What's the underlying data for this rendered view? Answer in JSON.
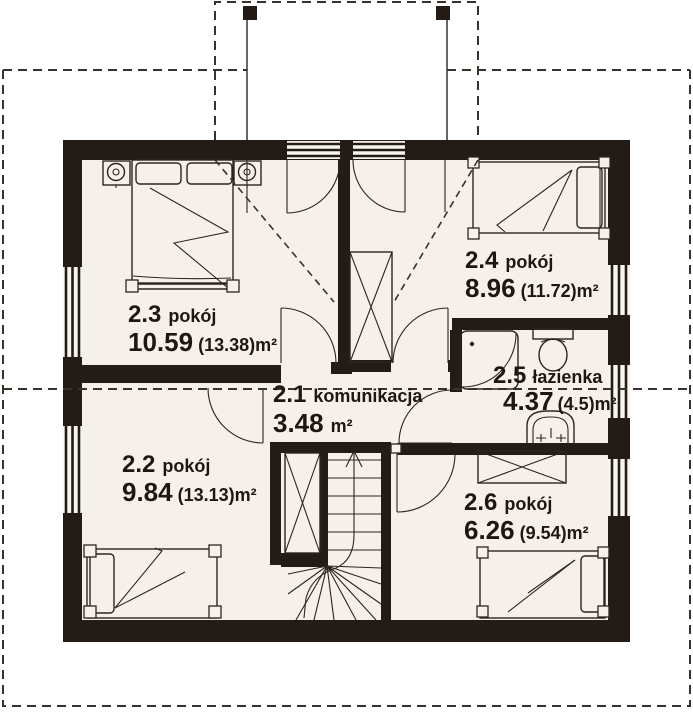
{
  "colors": {
    "background": "#ffffff",
    "floor": "#f5f0e9",
    "wall": "#221b16",
    "line": "#2c251f",
    "dashed_line": "#39322b",
    "text": "#1d1712"
  },
  "floorplan": {
    "rooms": [
      {
        "id": "2.1",
        "name": "komunikacja",
        "area": "3.48",
        "area_unit": "m²"
      },
      {
        "id": "2.2",
        "name": "pokój",
        "area": "9.84",
        "area_unit": "(13.13)m²"
      },
      {
        "id": "2.3",
        "name": "pokój",
        "area": "10.59",
        "area_unit": "(13.38)m²"
      },
      {
        "id": "2.4",
        "name": "pokój",
        "area": "8.96",
        "area_unit": "(11.72)m²"
      },
      {
        "id": "2.5",
        "name": "łazienka",
        "area": "4.37",
        "area_unit": "(4.5)m²"
      },
      {
        "id": "2.6",
        "name": "pokój",
        "area": "6.26",
        "area_unit": "(9.54)m²"
      }
    ]
  }
}
